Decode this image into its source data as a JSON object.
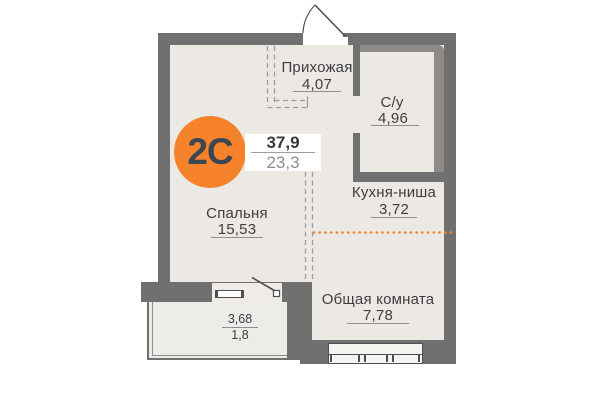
{
  "plan": {
    "badge": {
      "label": "2С",
      "total_area": "37,9",
      "living_area": "23,3"
    },
    "rooms": {
      "hallway": {
        "name": "Прихожая",
        "area": "4,07"
      },
      "bathroom": {
        "name": "С/у",
        "area": "4,96"
      },
      "kitchen": {
        "name": "Кухня-ниша",
        "area": "3,72"
      },
      "bedroom": {
        "name": "Спальня",
        "area": "15,53"
      },
      "living": {
        "name": "Общая комната",
        "area": "7,78"
      }
    },
    "balcony": {
      "area_total": "3,68",
      "area_counted": "1,8"
    },
    "colors": {
      "accent_orange": "#f6822c",
      "wall_gray": "#707070",
      "floor_beige": "#ece9e5",
      "dashed_gray": "#9b9b9b",
      "text_dark": "#3e3e3e"
    }
  }
}
